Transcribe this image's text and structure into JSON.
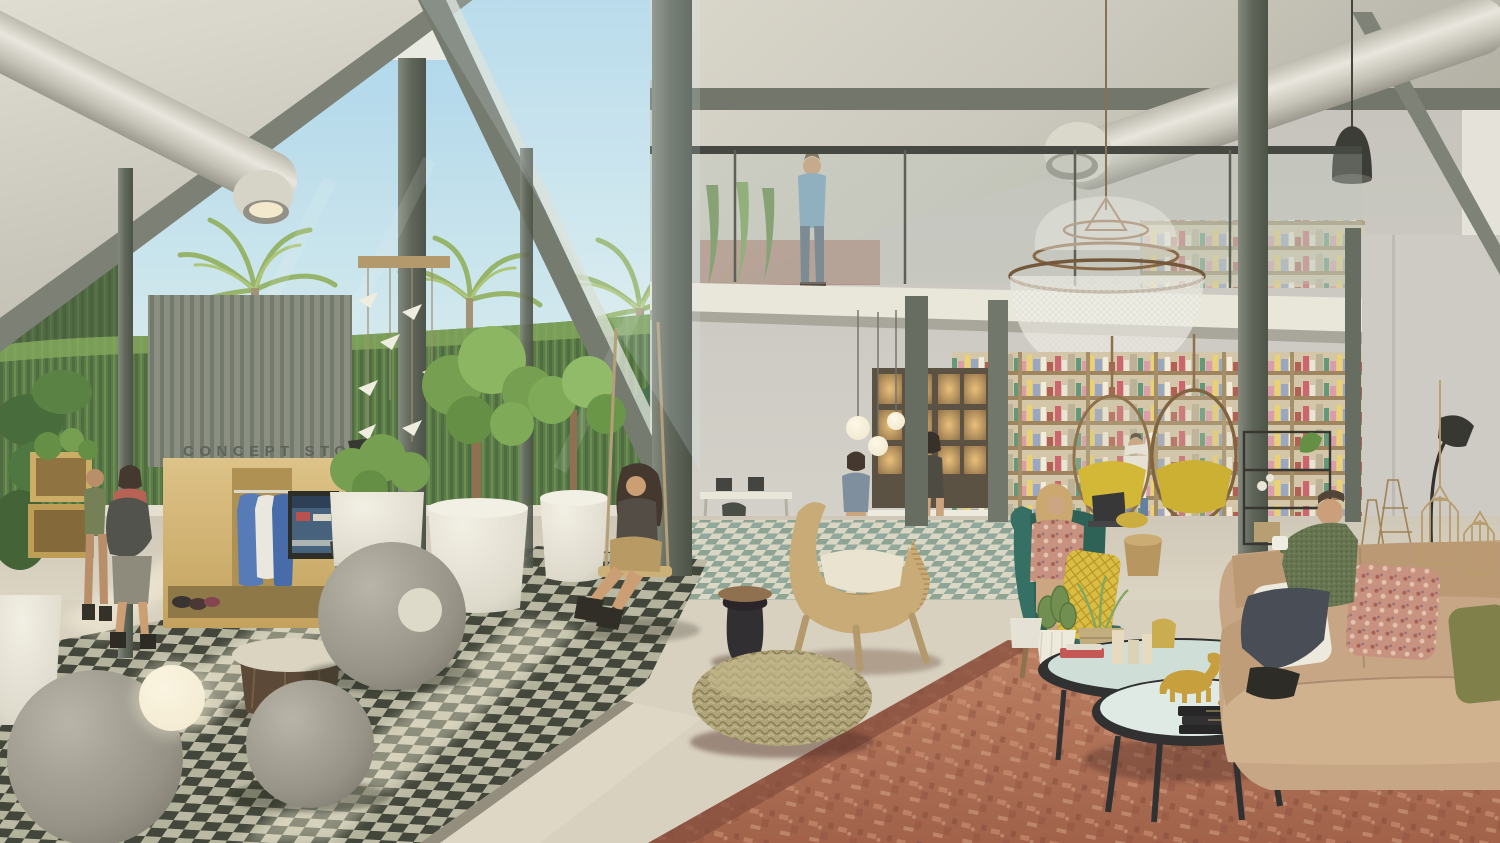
{
  "scene": {
    "kind": "architectural-interior-rendering",
    "description": "Sunlit double-height concept-store lobby with mezzanine library wall, lounge furniture, indoor trees, checkered tile floor and people",
    "time_of_day": "daylight"
  },
  "signage": {
    "concept_store": "CONCEPT STORE"
  },
  "palette": {
    "sky": "#b9ddee",
    "concrete_light": "#d9d6cc",
    "concrete_dark": "#b4b1a6",
    "steel": "#6a7066",
    "duct_silver": "#cfccc2",
    "plywood": "#d3b576",
    "foliage": "#7ba24f",
    "hedge": "#4f6f3f",
    "checker_dark": "#32352f",
    "checker_light": "#c6c2b2",
    "rug_red": "#ad6a50",
    "sofa_tan": "#c4a281",
    "teal_chair": "#2c685e",
    "book_wood": "#b59a6e",
    "brass": "#8a6a4a",
    "pineapple_yellow": "#d9ba3c"
  },
  "elements": [
    "concrete-ceiling",
    "ventilation-ducts",
    "steel-columns",
    "glass-atrium",
    "palm-trees",
    "hedge-wall",
    "concept-store-sign",
    "wardrobe-display",
    "tv-screen",
    "stone-spheres",
    "checker-floor",
    "swing-woman",
    "origami-bird-mobile",
    "white-planters",
    "mezzanine-man",
    "mesh-chandelier",
    "library-book-wall",
    "hanging-egg-chairs",
    "high-table-women",
    "rattan-lounge-chair",
    "wicker-pouf",
    "red-rug",
    "teal-armchair-woman",
    "coffee-tables",
    "golden-horse",
    "leather-sofa-man",
    "birdcages",
    "hikers"
  ]
}
